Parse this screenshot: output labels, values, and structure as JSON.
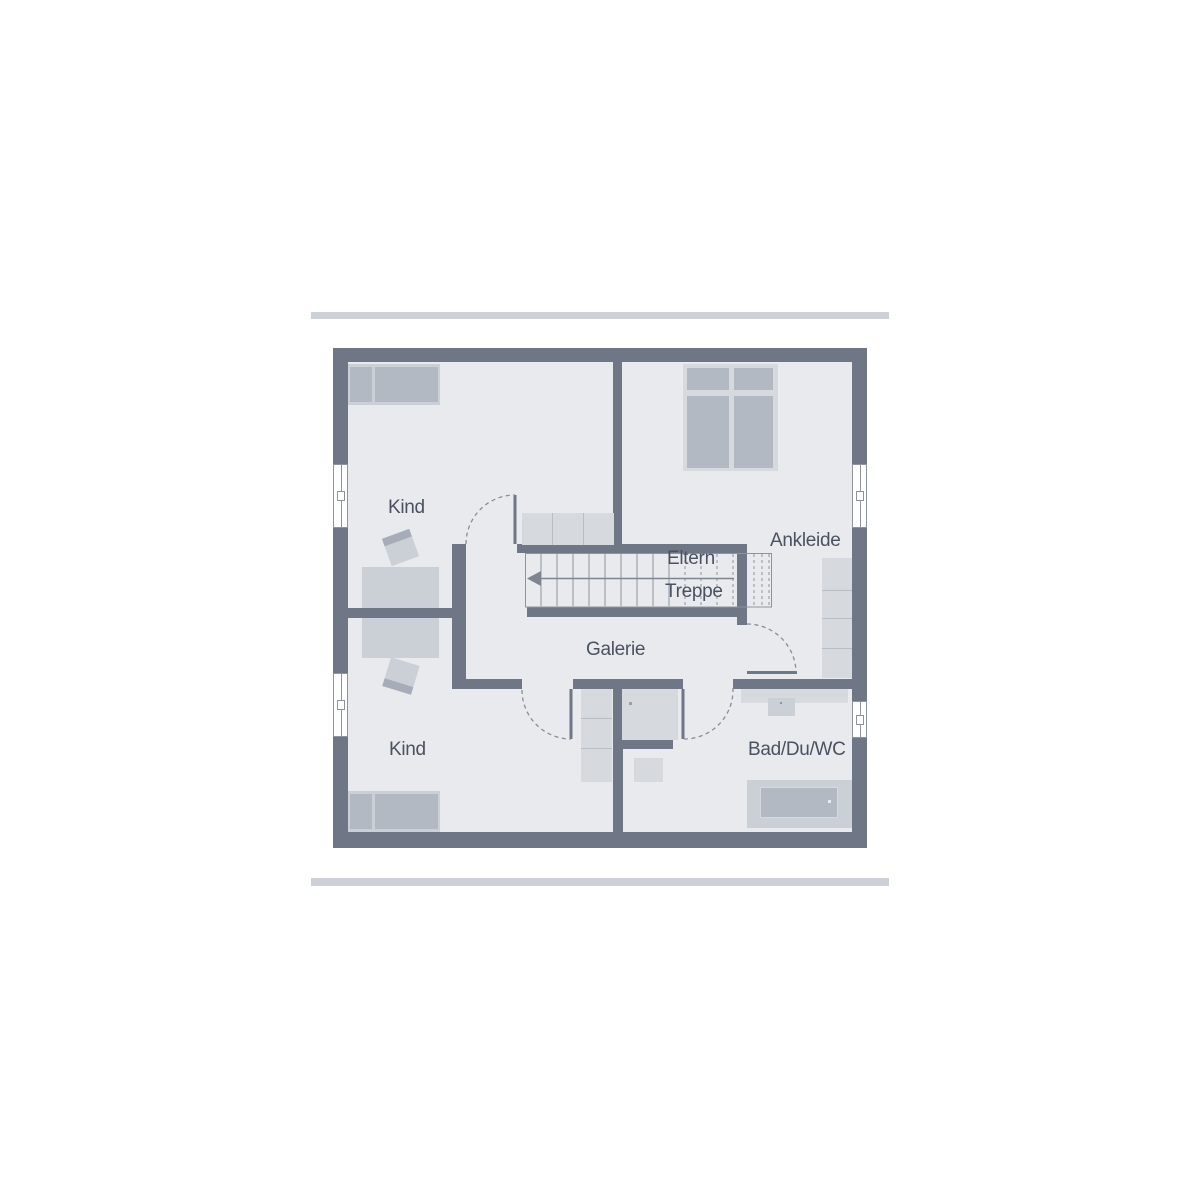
{
  "plan_title": "floor-plan-upper-storey",
  "rooms": [
    {
      "id": "kind-top",
      "label": "Kind"
    },
    {
      "id": "eltern",
      "label": "Eltern"
    },
    {
      "id": "ankleide",
      "label": "Ankleide"
    },
    {
      "id": "treppe",
      "label": "Treppe"
    },
    {
      "id": "galerie",
      "label": "Galerie"
    },
    {
      "id": "kind-bottom",
      "label": "Kind"
    },
    {
      "id": "bad",
      "label": "Bad/Du/WC"
    }
  ],
  "colors": {
    "bg": "#ffffff",
    "bar": "#cdd0d6",
    "wall": "#6f7685",
    "floor": "#e8eaee",
    "furn-a": "#d6d9de",
    "furn-b": "#cbcfd6",
    "furn-c": "#b3b9c2",
    "strip": "#a6adb8",
    "divider": "#b9bec6",
    "outline": "#8e949f",
    "dash": "#878e99",
    "arrow": "#7d8591",
    "dot-dark": "#9aa0aa",
    "text": "#4a5160"
  }
}
